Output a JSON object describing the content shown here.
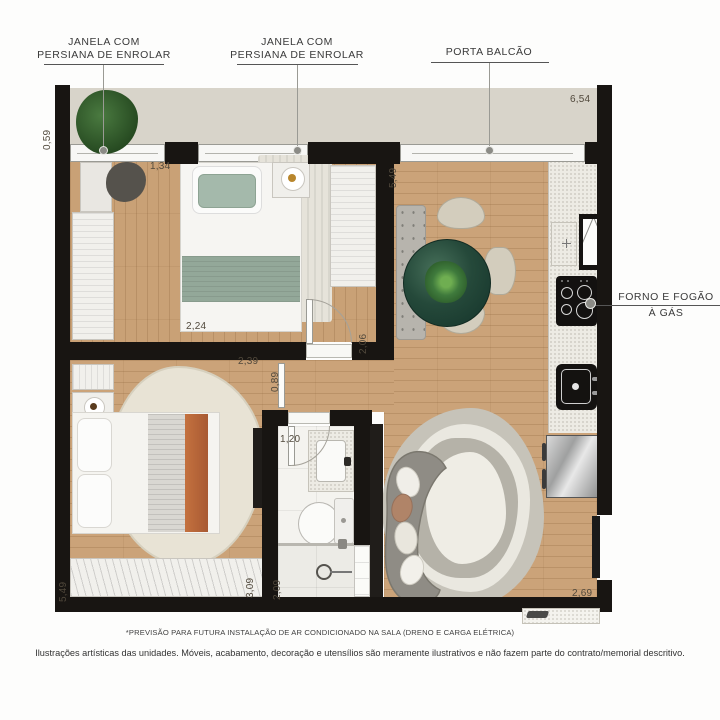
{
  "labels": {
    "window1": {
      "line1": "JANELA COM",
      "line2": "PERSIANA DE ENROLAR"
    },
    "window2": {
      "line1": "JANELA COM",
      "line2": "PERSIANA DE ENROLAR"
    },
    "balcony_door": "PORTA BALCÃO",
    "stove": {
      "line1": "FORNO E FOGÃO",
      "line2": "À GÁS"
    }
  },
  "dims": {
    "d059": "0,59",
    "d134": "1,34",
    "d654": "6,54",
    "d549a": "5,49",
    "d224": "2,24",
    "d239": "2,39",
    "d089": "0,89",
    "d206": "2,06",
    "d120": "1,20",
    "d209": "2,09",
    "d309": "3,09",
    "d549b": "5,49",
    "d269": "2,69"
  },
  "footnotes": {
    "line1": "*PREVISÃO PARA FUTURA INSTALAÇÃO DE AR CONDICIONADO NA SALA (DRENO E CARGA ELÉTRICA)",
    "line2": "Ilustrações artísticas das unidades. Móveis, acabamento, decoração e utensílios são meramente ilustrativos e não fazem parte do contrato/memorial descritivo."
  },
  "palette": {
    "wall": "#181512",
    "wood": "#cba379",
    "ledge": "#d8d4ca",
    "sage_green": "#93a899",
    "terracotta": "#bf6b42",
    "table_green": "#24453a",
    "plant_green": "#3f7a3c",
    "rug_cream": "#efede5",
    "grey_furniture": "#8f8c85"
  }
}
